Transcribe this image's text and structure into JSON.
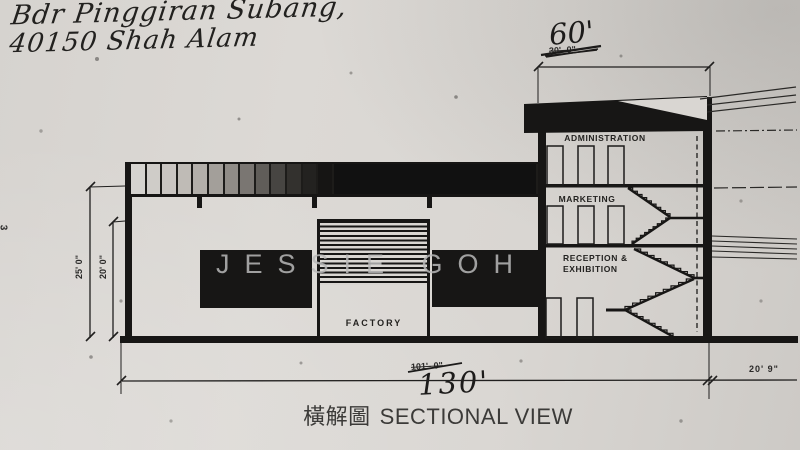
{
  "page": {
    "side_number": "3"
  },
  "handwritten_header": {
    "line1": "Bdr Pinggiran Subang,",
    "line2": "40150 Shah Alam"
  },
  "watermark": {
    "text": "JESSIE GOH"
  },
  "labels": {
    "administration": "ADMINISTRATION",
    "marketing": "MARKETING",
    "reception_line1": "RECEPTION &",
    "reception_line2": "EXHIBITION",
    "factory": "FACTORY"
  },
  "dimensions": {
    "top_revised_handwritten": "60'",
    "top_original_struck": "30'- 0\"",
    "left_outer": "25' 0\"",
    "left_inner": "20' 0\"",
    "bottom_revised_handwritten": "130'",
    "bottom_original_struck": "101'- 0\"",
    "bottom_right": "20' 9\""
  },
  "title": {
    "cjk": "橫解圖",
    "en": "SECTIONAL VIEW"
  },
  "colors": {
    "ink": "#171615",
    "paper": "#d9d6d2",
    "watermark_gray": "#b9b9b9"
  }
}
